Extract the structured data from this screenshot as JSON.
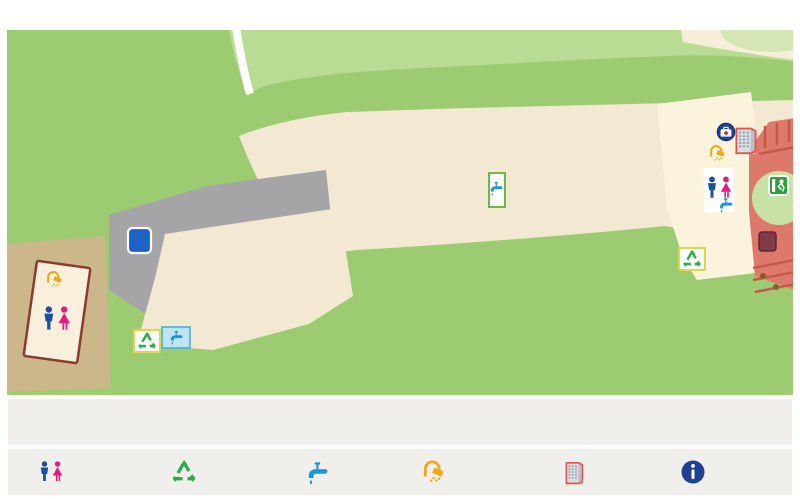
{
  "title": "캠핑장 전체 안내도",
  "map": {
    "park_label": "금강습지생태공원",
    "road_label": "철새로",
    "shelter_label": "대피소",
    "aid_box": {
      "line1": "소화기",
      "line2": "구급상자"
    },
    "parking_main_label": "P",
    "parking_shelter_label": "P",
    "sites": {
      "A": {
        "fill": "#29aae1",
        "badge_color": "#e01f26",
        "tiles": [
          {
            "id": "A1",
            "x": 631,
            "y": 96,
            "w": 30,
            "h": 38
          },
          {
            "id": "A2",
            "x": 596,
            "y": 100,
            "w": 30,
            "h": 38
          },
          {
            "id": "A3",
            "x": 561,
            "y": 103,
            "w": 32,
            "h": 46
          },
          {
            "id": "A4",
            "x": 527,
            "y": 107,
            "w": 32,
            "h": 46
          },
          {
            "id": "A5",
            "x": 493,
            "y": 111,
            "w": 32,
            "h": 46
          },
          {
            "id": "A6",
            "x": 414,
            "y": 117,
            "w": 30,
            "h": 44
          },
          {
            "id": "A7",
            "x": 380,
            "y": 120,
            "w": 30,
            "h": 44
          },
          {
            "id": "A8",
            "x": 346,
            "y": 123,
            "w": 30,
            "h": 44
          },
          {
            "id": "A9",
            "x": 312,
            "y": 127,
            "w": 30,
            "h": 44
          },
          {
            "id": "A10",
            "x": 633,
            "y": 135,
            "w": 32,
            "h": 32
          },
          {
            "id": "A11",
            "x": 599,
            "y": 138,
            "w": 32,
            "h": 32
          },
          {
            "id": "A12",
            "x": 553,
            "y": 151,
            "w": 30,
            "h": 40
          },
          {
            "id": "A13",
            "x": 519,
            "y": 157,
            "w": 30,
            "h": 40
          },
          {
            "id": "A14",
            "x": 416,
            "y": 162,
            "w": 30,
            "h": 42
          },
          {
            "id": "A15",
            "x": 384,
            "y": 165,
            "w": 30,
            "h": 42
          },
          {
            "id": "A16",
            "x": 348,
            "y": 168,
            "w": 30,
            "h": 42
          },
          {
            "id": "A17",
            "x": 314,
            "y": 171,
            "w": 30,
            "h": 42
          }
        ]
      },
      "B": {
        "fill": "#ffe115",
        "badge_color": "#ea1d7d",
        "tiles": [
          {
            "id": "B1",
            "x": 652,
            "y": 208,
            "w": 27,
            "h": 33
          },
          {
            "id": "B2",
            "x": 621,
            "y": 211,
            "w": 27,
            "h": 33
          },
          {
            "id": "B3",
            "x": 591,
            "y": 213,
            "w": 27,
            "h": 33
          },
          {
            "id": "B4",
            "x": 561,
            "y": 215,
            "w": 27,
            "h": 33
          },
          {
            "id": "B5",
            "x": 531,
            "y": 218,
            "w": 27,
            "h": 33
          },
          {
            "id": "B6",
            "x": 501,
            "y": 221,
            "w": 27,
            "h": 33
          },
          {
            "id": "B7",
            "x": 470,
            "y": 224,
            "w": 27,
            "h": 33
          },
          {
            "id": "B8",
            "x": 439,
            "y": 226,
            "w": 27,
            "h": 33
          },
          {
            "id": "B9",
            "x": 410,
            "y": 229,
            "w": 27,
            "h": 33
          },
          {
            "id": "B10",
            "x": 380,
            "y": 231,
            "w": 27,
            "h": 33
          },
          {
            "id": "B11",
            "x": 350,
            "y": 234,
            "w": 27,
            "h": 33
          }
        ]
      },
      "C": {
        "badge_color": "#17499d",
        "site_fill": "#f7941e",
        "labels": [
          {
            "id": "C1",
            "x": 277,
            "y": 176,
            "row": "top"
          },
          {
            "id": "C2",
            "x": 258,
            "y": 174,
            "row": "top"
          },
          {
            "id": "C3",
            "x": 240,
            "y": 178,
            "row": "top"
          },
          {
            "id": "C4",
            "x": 222,
            "y": 184,
            "row": "top"
          },
          {
            "id": "C5",
            "x": 203,
            "y": 191,
            "row": "top"
          },
          {
            "id": "C6",
            "x": 185,
            "y": 197,
            "row": "top"
          },
          {
            "id": "C7",
            "x": 168,
            "y": 203,
            "row": "top"
          },
          {
            "id": "C8",
            "x": 283,
            "y": 282,
            "row": "bottom"
          },
          {
            "id": "C9",
            "x": 267,
            "y": 287,
            "row": "bottom"
          },
          {
            "id": "C10",
            "x": 249,
            "y": 294,
            "row": "bottom"
          },
          {
            "id": "C11",
            "x": 231,
            "y": 300,
            "row": "bottom"
          },
          {
            "id": "C12",
            "x": 215,
            "y": 305,
            "row": "bottom"
          },
          {
            "id": "C13",
            "x": 197,
            "y": 313,
            "row": "bottom"
          }
        ]
      }
    }
  },
  "legend": {
    "sites": [
      {
        "letter": "A",
        "color": "#e8232a",
        "label": "오토사이트 A1~A17"
      },
      {
        "letter": "B",
        "color": "#ec2c87",
        "label": "오토사이트 B1~B11"
      },
      {
        "letter": "C",
        "color": "#1d5aa8",
        "label": "일반사이트 C1~C13"
      }
    ],
    "facilities": [
      {
        "icon": "toilet",
        "label": "화장실(남/여)"
      },
      {
        "icon": "recycle",
        "label": "분리수거장"
      },
      {
        "icon": "faucet",
        "label": "취사장"
      },
      {
        "icon": "shower",
        "label": "샤워실(남/여)"
      },
      {
        "icon": "building",
        "label": "관리동"
      },
      {
        "icon": "info",
        "label": "사무실/매점"
      }
    ]
  }
}
